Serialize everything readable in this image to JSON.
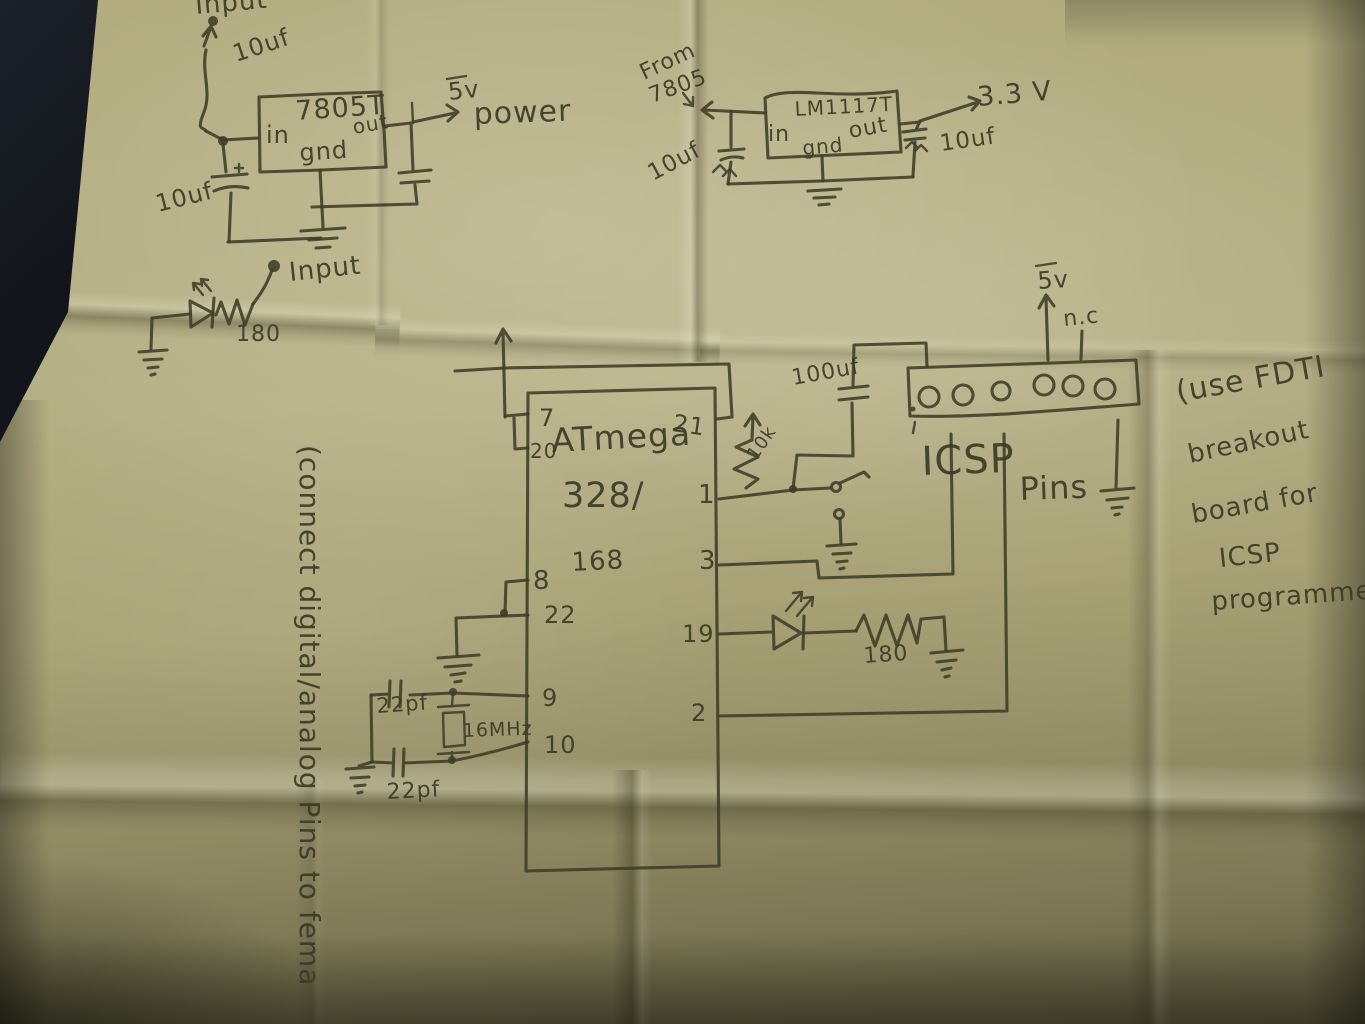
{
  "photo": {
    "description": "Photograph of a hand-drawn microcontroller power and ICSP schematic in ink on a folded sheet of paper",
    "paper_color": "#b0aa7d",
    "ink_color": "#3d3c28",
    "table_color": "#171a21"
  },
  "power_5v_circuit": {
    "input_label": "Input",
    "cap_top_label": "10uf",
    "regulator_name": "7805T",
    "pin_in": "in",
    "pin_gnd": "gnd",
    "pin_out": "out",
    "output_voltage": "5v",
    "output_label": "power",
    "cap_bottom_label": "10uf"
  },
  "power_3v3_circuit": {
    "source_label_line1": "From",
    "source_label_line2": "7805",
    "regulator_name": "LM1117T",
    "pin_in": "in",
    "pin_gnd": "gnd",
    "pin_out": "out",
    "cap_in_label": "10uf",
    "cap_out_label": "10uf",
    "output_voltage": "3.3 V"
  },
  "input_led_circuit": {
    "input_label": "Input",
    "resistor_label": "180"
  },
  "mcu": {
    "name_line1": "ATmega",
    "name_line2": "328/",
    "name_line3": "168",
    "pin7": "7",
    "pin20": "20",
    "pin21": "21",
    "pin1": "1",
    "pin3": "3",
    "pin19": "19",
    "pin2": "2",
    "pin8": "8",
    "pin22": "22",
    "pin9": "9",
    "pin10": "10",
    "pullup_resistor_label": "10k",
    "decoupling_cap_label": "100uf",
    "crystal_label": "16MHz",
    "crystal_cap1_label": "22pf",
    "crystal_cap2_label": "22pf",
    "led_resistor_label": "180"
  },
  "icsp": {
    "title_line1": "ICSP",
    "title_line2": "Pins",
    "supply_label": "5v",
    "nc_label": "n.c"
  },
  "notes": {
    "left_rotated": "(connect digital/analog Pins to fema",
    "right_line1": "(use FDTI",
    "right_line2": "breakout",
    "right_line3": "board for",
    "right_line4": "ICSP",
    "right_line5": "programmer)"
  }
}
